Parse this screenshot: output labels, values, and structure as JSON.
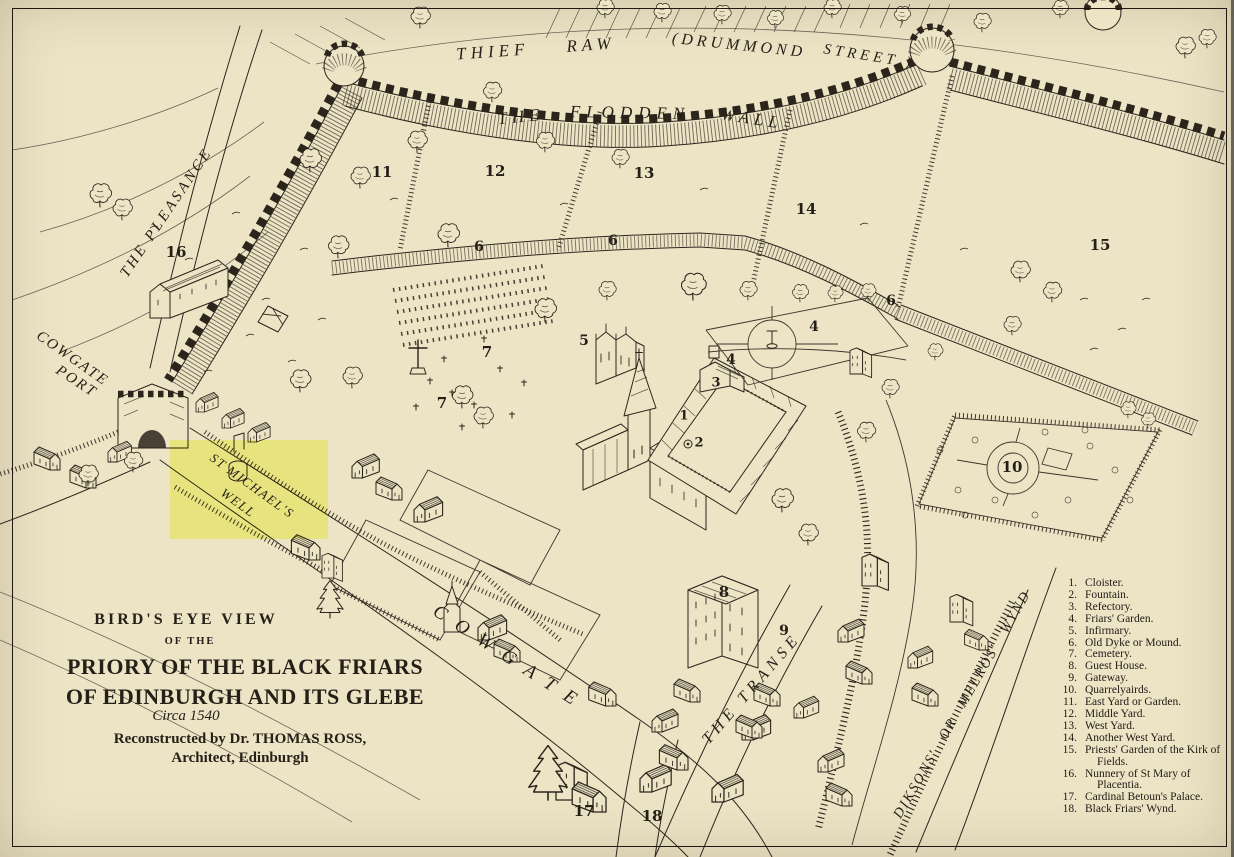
{
  "title_block": {
    "line1": "BIRD'S  EYE  VIEW",
    "line2": "OF  THE",
    "line3": "PRIORY  OF  THE  BLACK  FRIARS",
    "line4": "OF  EDINBURGH  AND  ITS  GLEBE",
    "line5": "Circa 1540",
    "line6": "Reconstructed  by  Dr.  THOMAS  ROSS,",
    "line7": "Architect,  Edinburgh"
  },
  "labels": {
    "thief_raw": "THIEF RAW",
    "drummond": "(DRUMMOND",
    "street": "STREET )",
    "the": "THE",
    "flodden": "FLODDEN",
    "wall": "WALL",
    "pleasance": "THE PLEASANCE",
    "cowgate_port_line1": "COWGATE",
    "cowgate_port_line2": "PORT",
    "cowgate_street": "COWGATE",
    "transe": "THE TRANSE",
    "melros_wynd": "DIKSONS' OR MELROS' WYND",
    "well_line1": "ST MICHAEL'S",
    "well_line2": "WELL"
  },
  "map_numbers": [
    "16",
    "11",
    "12",
    "13",
    "14",
    "15",
    "6",
    "6",
    "6",
    "7",
    "7",
    "5",
    "4",
    "4",
    "3",
    "1",
    "2",
    "10",
    "8",
    "9",
    "17",
    "18"
  ],
  "legend": {
    "items": [
      {
        "num": "1.",
        "text": "Cloister."
      },
      {
        "num": "2.",
        "text": "Fountain."
      },
      {
        "num": "3.",
        "text": "Refectory."
      },
      {
        "num": "4.",
        "text": "Friars' Garden."
      },
      {
        "num": "5.",
        "text": "Infirmary."
      },
      {
        "num": "6.",
        "text": "Old Dyke or Mound."
      },
      {
        "num": "7.",
        "text": "Cemetery."
      },
      {
        "num": "8.",
        "text": "Guest House."
      },
      {
        "num": "9.",
        "text": "Gateway."
      },
      {
        "num": "10.",
        "text": "Quarrelyairds."
      },
      {
        "num": "11.",
        "text": "East Yard or Garden."
      },
      {
        "num": "12.",
        "text": "Middle Yard."
      },
      {
        "num": "13.",
        "text": "West Yard."
      },
      {
        "num": "14.",
        "text": "Another West Yard."
      },
      {
        "num": "15.",
        "text": "Priests' Garden of the Kirk of Fields."
      },
      {
        "num": "16.",
        "text": "Nunnery of St Mary of Placentia."
      },
      {
        "num": "17.",
        "text": "Cardinal Betoun's Palace."
      },
      {
        "num": "18.",
        "text": "Black Friars' Wynd."
      }
    ]
  },
  "colors": {
    "paper": "#EDE4C6",
    "ink": "#2B251C",
    "highlight": "#F9FF9E"
  }
}
